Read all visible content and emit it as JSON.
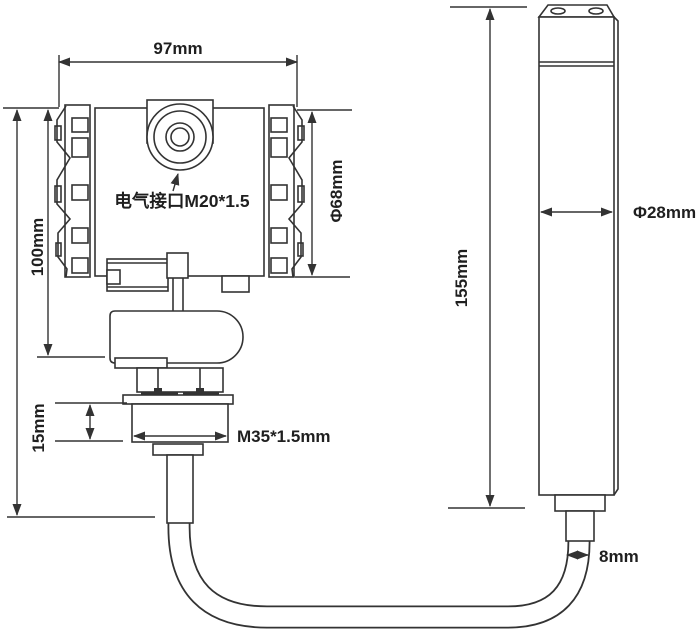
{
  "drawing": {
    "type": "engineering-dimension-diagram",
    "subject": "submersible-level-transmitter-with-probe",
    "colors": {
      "line": "#333333",
      "text": "#1f1f1f",
      "background": "#ffffff"
    },
    "labels": {
      "housing_width": "97mm",
      "housing_height": "100mm",
      "housing_diameter": "Φ68mm",
      "electrical_port": "电气接口M20*1.5",
      "thread_height": "15mm",
      "thread_spec": "M35*1.5mm",
      "probe_length": "155mm",
      "probe_diameter": "Φ28mm",
      "cable_diameter": "8mm"
    }
  }
}
